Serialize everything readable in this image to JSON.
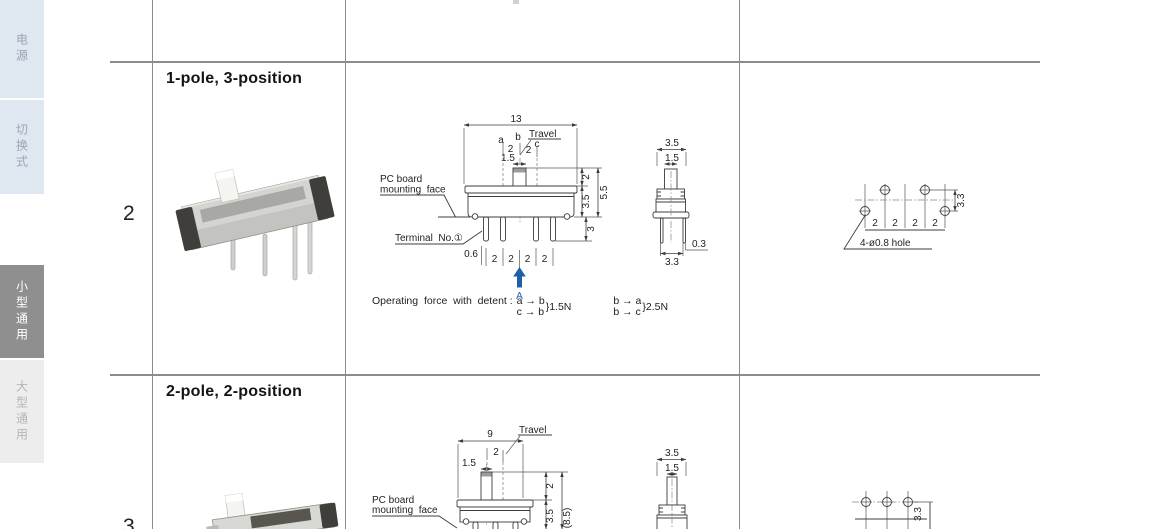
{
  "sidebar": {
    "tabs": [
      {
        "label": "电源"
      },
      {
        "label": "切换式"
      },
      {
        "label": "小型通用"
      },
      {
        "label": "大型通用"
      }
    ]
  },
  "rows": {
    "r2": {
      "number": "2",
      "title": "1-pole, 3-position",
      "front": {
        "dim_width": "13",
        "pos_a": "a",
        "pos_b": "b",
        "pos_c": "c",
        "travel_label": "Travel",
        "travel_ab": "2",
        "travel_bc": "2",
        "dim_knob_w": "1.5",
        "dim_knob_h": "2",
        "dim_body_h": "3.5",
        "dim_total_h": "5.5",
        "dim_pin_len": "3",
        "label_pcb_1": "PC board",
        "label_pcb_2": "mounting  face",
        "label_terminal": "Terminal  No.①",
        "dim_pin_offset": "0.6",
        "pitch": [
          "2",
          "2",
          "2",
          "2"
        ],
        "section_label": "A"
      },
      "side": {
        "dim_w": "3.5",
        "dim_knob": "1.5",
        "dim_leg_t": "0.3",
        "dim_leg_span": "3.3"
      },
      "force": {
        "label": "Operating  force  with  detent :",
        "g1a": "a → b",
        "g1b": "c → b",
        "g1v": "}1.5N",
        "g2a": "b → a",
        "g2b": "b → c",
        "g2v": "}2.5N"
      },
      "holes": {
        "pitch": [
          "2",
          "2",
          "2",
          "2"
        ],
        "row_gap": "3.3",
        "label": "4-ø0.8 hole"
      }
    },
    "r3": {
      "number": "3",
      "title": "2-pole, 2-position",
      "front": {
        "dim_width": "9",
        "travel_label": "Travel",
        "travel": "2",
        "dim_knob_w": "1.5",
        "dim_knob_h": "2",
        "dim_body_h": "3.5",
        "dim_total_h": "(8.5)",
        "label_pcb_1": "PC board",
        "label_pcb_2": "mounting  face"
      },
      "side": {
        "dim_w": "3.5",
        "dim_knob": "1.5"
      },
      "holes": {
        "row_gap": "3.3"
      }
    }
  }
}
